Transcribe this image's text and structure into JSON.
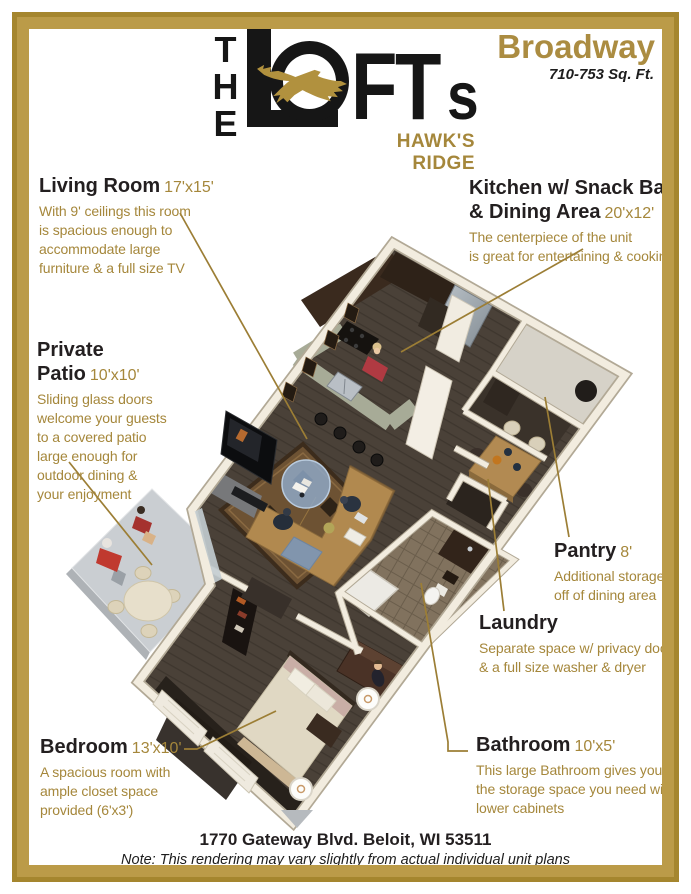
{
  "colors": {
    "gold_text": "#a5873b",
    "gold_brand": "#ab8c41",
    "frame_gold": "#bb9b48",
    "frame_gold_dark": "#a5862e",
    "heading_black": "#231f20",
    "leader_line": "#9c7e35"
  },
  "logo": {
    "the": "THE",
    "l": "L",
    "o": "O",
    "ft": "FT",
    "s": "s",
    "tagline": "HAWK'S RIDGE",
    "hawk_icon": "hawk-icon"
  },
  "header": {
    "plan_name": "Broadway",
    "sqft": "710-753 Sq. Ft."
  },
  "annotations": {
    "living_room": {
      "title": "Living Room",
      "dims": "17'x15'",
      "body": "With 9' ceilings this room\nis spacious enough to\naccommodate large\nfurniture & a full size TV"
    },
    "kitchen": {
      "title_line1": "Kitchen w/ Snack Bar",
      "title_line2": "& Dining Area",
      "dims": "20'x12'",
      "body": "The centerpiece of the unit\nis great for entertaining & cooking"
    },
    "private_patio": {
      "title": "Private Patio",
      "dims": "10'x10'",
      "body": "Sliding glass doors\nwelcome your guests\nto a covered patio\nlarge enough for\noutdoor dining &\nyour enjoyment"
    },
    "pantry": {
      "title": "Pantry",
      "dims": "8'",
      "body": "Additional storage\noff of dining area"
    },
    "laundry": {
      "title": "Laundry",
      "dims": "",
      "body": "Separate space w/ privacy doors\n& a full size washer & dryer"
    },
    "bedroom": {
      "title": "Bedroom",
      "dims": "13'x10'",
      "body": "A spacious room with\nample closet space\nprovided (6'x3')"
    },
    "bathroom": {
      "title": "Bathroom",
      "dims": "10'x5'",
      "body": "This large Bathroom gives you all\nthe storage space you need with\nlower cabinets"
    }
  },
  "footer": {
    "address": "1770 Gateway Blvd. Beloit, WI 53511",
    "note": "Note: This rendering may vary slightly from actual individual unit plans"
  }
}
